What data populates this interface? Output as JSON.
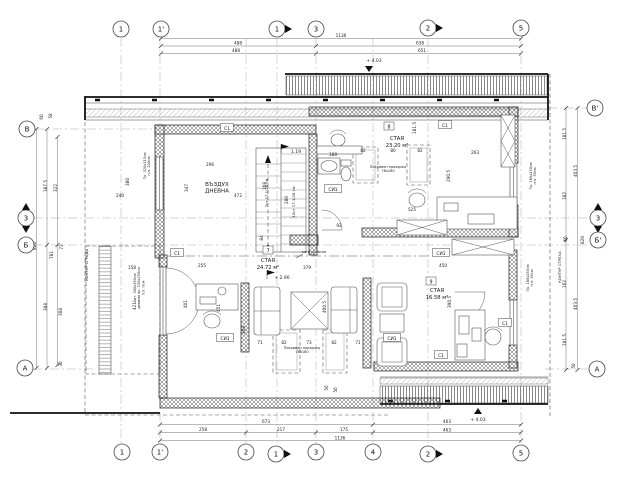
{
  "colors": {
    "line": "#1a1a1a",
    "paper": "#ffffff",
    "hatch": "#555"
  },
  "axes": [
    {
      "t": "1",
      "x": 121,
      "y": 29
    },
    {
      "t": "1'",
      "x": 161,
      "y": 29
    },
    {
      "t": "1",
      "x": 277,
      "y": 29,
      "a": "r"
    },
    {
      "t": "3",
      "x": 316,
      "y": 29
    },
    {
      "t": "2",
      "x": 428,
      "y": 28,
      "a": "r"
    },
    {
      "t": "5",
      "x": 521,
      "y": 28
    },
    {
      "t": "1",
      "x": 122,
      "y": 452
    },
    {
      "t": "1'",
      "x": 160,
      "y": 452
    },
    {
      "t": "2",
      "x": 246,
      "y": 452
    },
    {
      "t": "1",
      "x": 276,
      "y": 454,
      "a": "r"
    },
    {
      "t": "3",
      "x": 316,
      "y": 452
    },
    {
      "t": "4",
      "x": 373,
      "y": 452
    },
    {
      "t": "2",
      "x": 428,
      "y": 454,
      "a": "r"
    },
    {
      "t": "5",
      "x": 521,
      "y": 453
    },
    {
      "t": "В",
      "x": 27,
      "y": 129
    },
    {
      "t": "3",
      "x": 26,
      "y": 218,
      "a": "v"
    },
    {
      "t": "Б",
      "x": 26,
      "y": 245
    },
    {
      "t": "А",
      "x": 25,
      "y": 368
    },
    {
      "t": "В'",
      "x": 595,
      "y": 108
    },
    {
      "t": "3",
      "x": 598,
      "y": 218,
      "a": "v"
    },
    {
      "t": "Б'",
      "x": 598,
      "y": 240
    },
    {
      "t": "А",
      "x": 597,
      "y": 369
    }
  ],
  "dims": [
    {
      "t": "1136",
      "x": 341,
      "y": 37
    },
    {
      "t": "488",
      "x": 238,
      "y": 44.5
    },
    {
      "t": "638",
      "x": 420,
      "y": 44.5
    },
    {
      "t": "488",
      "x": 236,
      "y": 52
    },
    {
      "t": "651",
      "x": 422,
      "y": 52
    },
    {
      "t": "673",
      "x": 266,
      "y": 423
    },
    {
      "t": "463",
      "x": 447,
      "y": 423
    },
    {
      "t": "258",
      "x": 203,
      "y": 431
    },
    {
      "t": "217",
      "x": 281,
      "y": 431
    },
    {
      "t": "175",
      "x": 344,
      "y": 431
    },
    {
      "t": "463",
      "x": 447,
      "y": 431.5
    },
    {
      "t": "1136",
      "x": 340,
      "y": 439.5
    },
    {
      "t": "820",
      "x": 36,
      "y": 246,
      "r": -90
    },
    {
      "t": "387.5",
      "x": 47,
      "y": 186,
      "r": -90
    },
    {
      "t": "388",
      "x": 47,
      "y": 307,
      "r": -90
    },
    {
      "t": "322",
      "x": 57,
      "y": 188,
      "r": -90
    },
    {
      "t": "308",
      "x": 62,
      "y": 312,
      "r": -90
    },
    {
      "t": "781",
      "x": 53,
      "y": 255,
      "r": -90
    },
    {
      "t": "73",
      "x": 63,
      "y": 247,
      "r": -90
    },
    {
      "t": "60",
      "x": 43,
      "y": 117,
      "r": -90
    },
    {
      "t": "58",
      "x": 52,
      "y": 116,
      "r": -90
    },
    {
      "t": "30",
      "x": 62,
      "y": 364,
      "r": -90
    },
    {
      "t": "181.5",
      "x": 566,
      "y": 134,
      "r": -90
    },
    {
      "t": "403.5",
      "x": 577,
      "y": 171,
      "r": -90
    },
    {
      "t": "182",
      "x": 566,
      "y": 196,
      "r": -90
    },
    {
      "t": "60",
      "x": 567,
      "y": 239,
      "r": -90
    },
    {
      "t": "820",
      "x": 584,
      "y": 240,
      "r": -90
    },
    {
      "t": "162",
      "x": 566,
      "y": 284,
      "r": -90
    },
    {
      "t": "403.5",
      "x": 577,
      "y": 304,
      "r": -90
    },
    {
      "t": "181.5",
      "x": 566,
      "y": 340,
      "r": -90
    },
    {
      "t": "50",
      "x": 575,
      "y": 366,
      "r": -90
    },
    {
      "t": "296",
      "x": 210,
      "y": 166
    },
    {
      "t": "472",
      "x": 238,
      "y": 197
    },
    {
      "t": "347",
      "x": 188,
      "y": 188,
      "r": -90
    },
    {
      "t": "263",
      "x": 475,
      "y": 154
    },
    {
      "t": "240",
      "x": 120,
      "y": 197
    },
    {
      "t": "380",
      "x": 129,
      "y": 182,
      "r": -90
    },
    {
      "t": "181.5",
      "x": 416,
      "y": 128,
      "r": -90
    },
    {
      "t": "290.5",
      "x": 450,
      "y": 176,
      "r": -90
    },
    {
      "t": "450",
      "x": 443,
      "y": 267
    },
    {
      "t": "390.5",
      "x": 451,
      "y": 302,
      "r": -90
    },
    {
      "t": "400.5",
      "x": 326,
      "y": 307,
      "r": -90
    },
    {
      "t": "379",
      "x": 307,
      "y": 269
    },
    {
      "t": "255",
      "x": 202,
      "y": 267
    },
    {
      "t": "158",
      "x": 132,
      "y": 269
    },
    {
      "t": "421",
      "x": 136,
      "y": 306,
      "r": -90
    },
    {
      "t": "401",
      "x": 187,
      "y": 304,
      "r": -90
    },
    {
      "t": "451",
      "x": 220,
      "y": 308,
      "r": -90
    },
    {
      "t": "268",
      "x": 245,
      "y": 330,
      "r": -90
    },
    {
      "t": "71",
      "x": 260,
      "y": 344
    },
    {
      "t": "82",
      "x": 284,
      "y": 344
    },
    {
      "t": "73",
      "x": 309,
      "y": 344
    },
    {
      "t": "82",
      "x": 334,
      "y": 344
    },
    {
      "t": "71",
      "x": 358,
      "y": 344
    },
    {
      "t": "56",
      "x": 328,
      "y": 388,
      "r": -90
    },
    {
      "t": "50",
      "x": 337,
      "y": 390,
      "r": -90
    },
    {
      "t": "92",
      "x": 339,
      "y": 227
    },
    {
      "t": "188",
      "x": 333,
      "y": 156
    },
    {
      "t": "82",
      "x": 363,
      "y": 152
    },
    {
      "t": "80",
      "x": 393,
      "y": 152
    },
    {
      "t": "82",
      "x": 420,
      "y": 152
    },
    {
      "t": "525",
      "x": 412,
      "y": 211
    },
    {
      "t": "168",
      "x": 266,
      "y": 186,
      "r": -90
    },
    {
      "t": "280",
      "x": 288,
      "y": 200,
      "r": -90
    },
    {
      "t": "84",
      "x": 263,
      "y": 238,
      "r": -90
    },
    {
      "t": "7ст 17.1/28 см",
      "x": 268,
      "y": 193,
      "r": -90,
      "s": 3.8
    },
    {
      "t": "10ст 17.1/28 см",
      "x": 295,
      "y": 202,
      "r": -90,
      "s": 3.8
    }
  ],
  "tags": [
    {
      "t": "С1",
      "x": 227,
      "y": 128,
      "w": 13
    },
    {
      "t": "С1",
      "x": 445,
      "y": 125,
      "w": 13
    },
    {
      "t": "С1",
      "x": 177,
      "y": 253,
      "w": 13
    },
    {
      "t": "С1",
      "x": 505,
      "y": 323,
      "w": 13
    },
    {
      "t": "С1",
      "x": 441,
      "y": 355,
      "w": 13
    },
    {
      "t": "СИ1",
      "x": 333,
      "y": 189,
      "w": 17
    },
    {
      "t": "СИ1",
      "x": 441,
      "y": 253,
      "w": 17
    },
    {
      "t": "СИ1",
      "x": 225,
      "y": 338,
      "w": 17
    },
    {
      "t": "СИ1",
      "x": 392,
      "y": 338,
      "w": 17
    }
  ],
  "rooms": {
    "r8": {
      "num": "8",
      "name": "СТАЯ",
      "area": "23.20 м²"
    },
    "r7": {
      "num": "7",
      "name": "СТАЯ",
      "area": "24.72 м²"
    },
    "r9": {
      "num": "9",
      "name": "СТАЯ",
      "area": "16.58 м²"
    }
  },
  "notes": [
    {
      "t": "ВЪЗДУХ\nДНЕВНА",
      "x": 217,
      "y": 186,
      "s": 5.6
    },
    {
      "t": "контур било",
      "x": 314,
      "y": 253,
      "s": 3.8
    },
    {
      "t": "КОНТУР СГРАДА",
      "x": 88,
      "y": 265,
      "r": -90,
      "s": 3.8
    },
    {
      "t": "КОНТУР СТРЕХА",
      "x": 561,
      "y": 267,
      "r": -90,
      "s": 3.8
    },
    {
      "t": "Пр. 320х315см\nп.п. 200см",
      "x": 146,
      "y": 166,
      "r": -90,
      "s": 3.5
    },
    {
      "t": "Пр. 180х250см\nп.п. 50см",
      "x": 532,
      "y": 176,
      "r": -90,
      "s": 3.5
    },
    {
      "t": "Пр. 180х250см\nп.п. 50см",
      "x": 529,
      "y": 278,
      "r": -90,
      "s": 3.5
    },
    {
      "t": "Вит. 300х350см\nделимо вр. 150х250см\nп.п. 0см",
      "x": 136,
      "y": 288,
      "r": -90,
      "s": 3.5
    },
    {
      "t": "Покривен прозорец\n78х160",
      "x": 388,
      "y": 168,
      "s": 3.5
    },
    {
      "t": "Покривен прозорец\n78х160",
      "x": 302,
      "y": 349,
      "s": 3.5
    }
  ],
  "levels": [
    {
      "t": "+ 4.03",
      "x": 374,
      "y": 62,
      "s": 4.5
    },
    {
      "t": "+ 4.03",
      "x": 478,
      "y": 421,
      "s": 4.5
    },
    {
      "t": "1.19",
      "x": 296,
      "y": 153,
      "s": 4.5
    },
    {
      "t": "+ 2.90",
      "x": 282,
      "y": 279,
      "s": 4.5
    }
  ]
}
